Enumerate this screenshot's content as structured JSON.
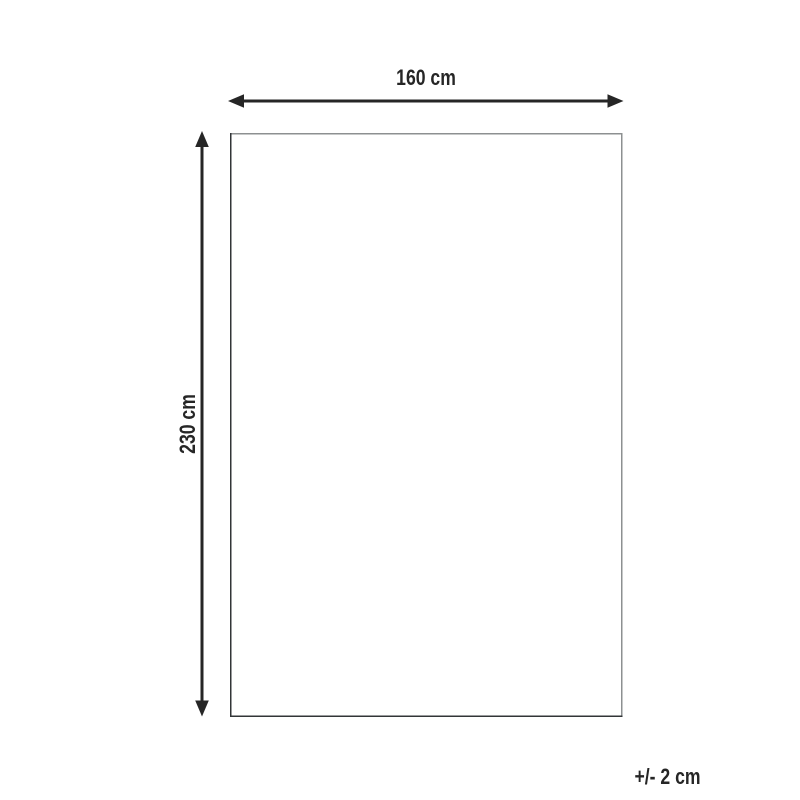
{
  "diagram": {
    "width_label": "160 cm",
    "height_label": "230 cm",
    "tolerance_label": "+/- 2 cm",
    "colors": {
      "line": "#262626",
      "text": "#262626",
      "outline_light": "#8d9091",
      "outline_dark": "#323537",
      "background": "#ffffff"
    }
  }
}
